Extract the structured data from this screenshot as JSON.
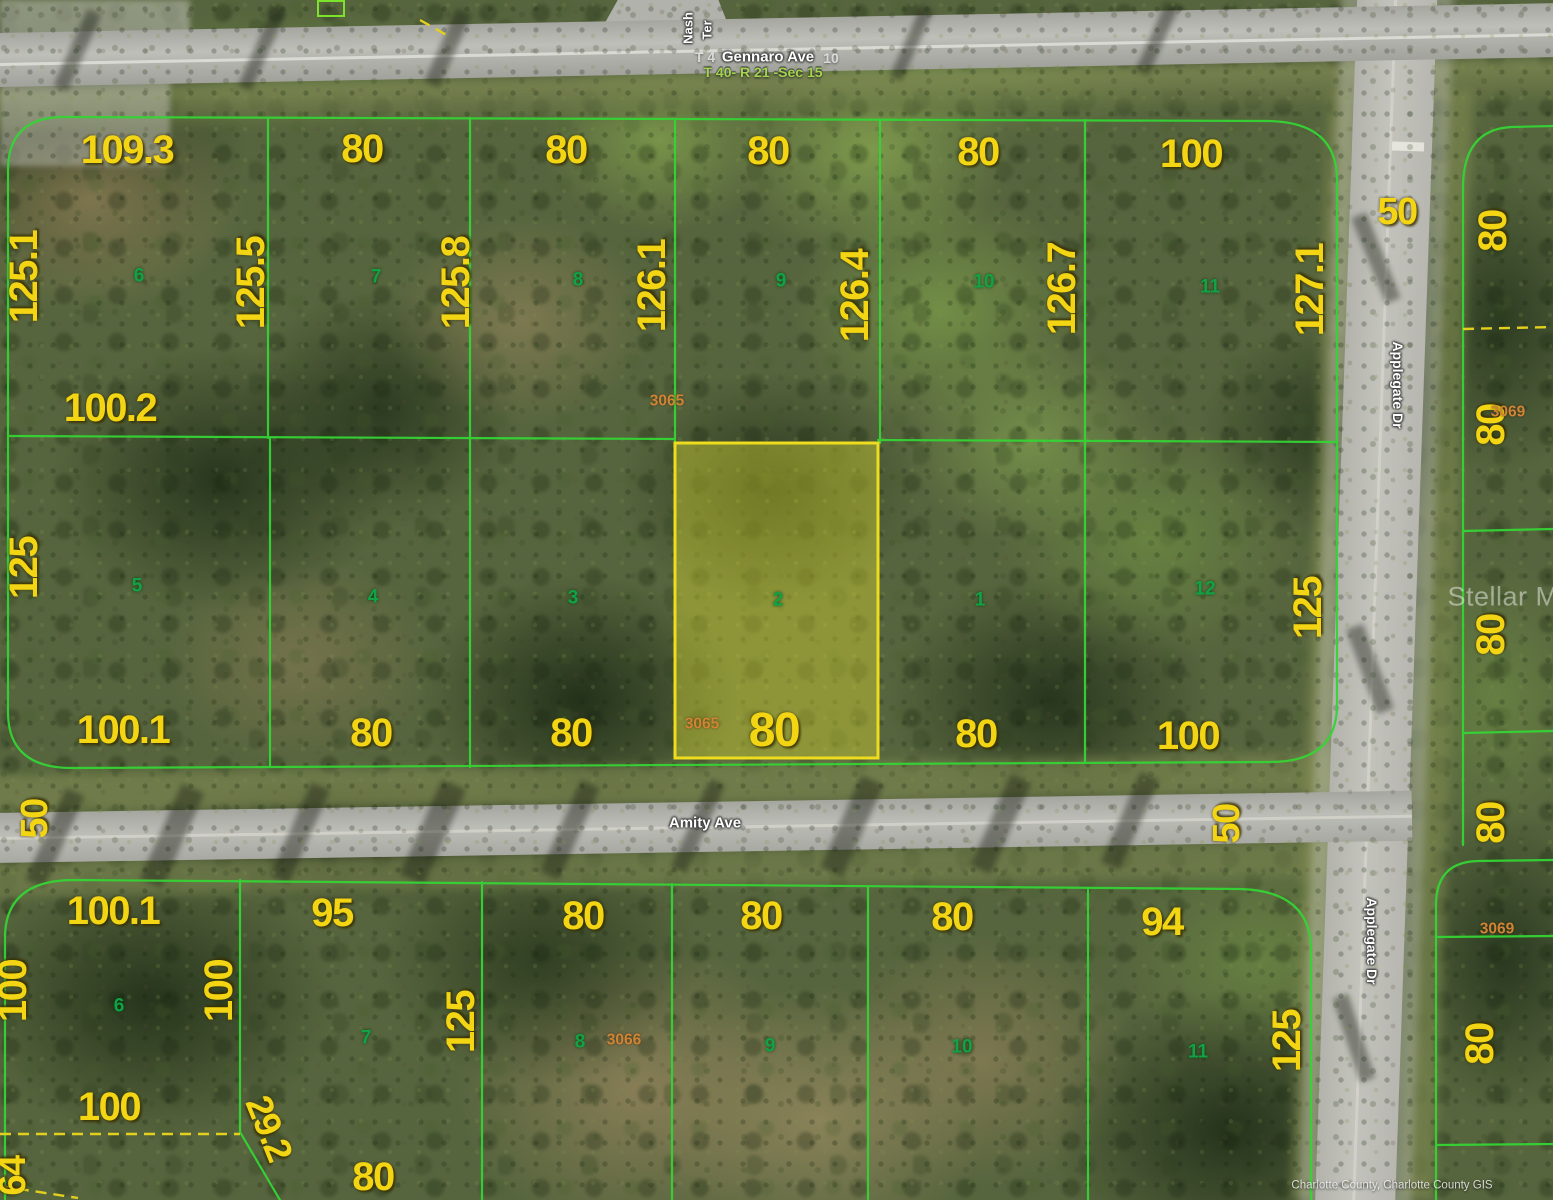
{
  "map": {
    "type": "aerial-parcel-map",
    "subject_parcel": {
      "lot": "2",
      "parcel_id": "3065",
      "frontage": "80",
      "highlighted": true
    },
    "watermark": "Stellar MLS",
    "attribution": "Charlotte County, Charlotte County GIS",
    "streets": {
      "north": "Gennaro Ave",
      "middle": "Amity Ave",
      "east": "Applegate Dr",
      "northwest": "Nash Ter",
      "township_range_section": "T 40- R 21 -Sec 15"
    },
    "colors": {
      "boundary_green": "#35d435",
      "dimension_yellow": "#f3d513",
      "lot_number_green": "#12a246",
      "parcel_id_orange": "#d08434",
      "highlight_stroke": "#eedc1e",
      "highlight_fill": "rgba(232,228,50,0.38)",
      "dashed_yellow": "#e3cf1e",
      "road_gray": "#b3b3ad"
    }
  },
  "labels": [
    {
      "name": "street-nash-line1",
      "kind": "street",
      "text": "Nash",
      "x": 688,
      "y": 28,
      "rot": -90,
      "size": 13
    },
    {
      "name": "street-nash-line2",
      "kind": "street",
      "text": "Ter",
      "x": 707,
      "y": 30,
      "rot": -90,
      "size": 13
    },
    {
      "name": "street-gennaro-prefix",
      "kind": "street-faint",
      "text": "T 4",
      "x": 705,
      "y": 57
    },
    {
      "name": "street-gennaro",
      "kind": "street",
      "text": "Gennaro Ave",
      "x": 768,
      "y": 57
    },
    {
      "name": "street-gennaro-suffix",
      "kind": "street-faint",
      "text": "10",
      "x": 831,
      "y": 58
    },
    {
      "name": "township-range-section",
      "kind": "twp",
      "text": "T 40- R 21 -Sec 15",
      "x": 763,
      "y": 72
    },
    {
      "name": "street-amity",
      "kind": "street",
      "text": "Amity Ave",
      "x": 705,
      "y": 823
    },
    {
      "name": "street-applegate-north",
      "kind": "street",
      "text": "Applegate Dr",
      "x": 1398,
      "y": 385,
      "rot": 90,
      "size": 14
    },
    {
      "name": "street-applegate-south",
      "kind": "street",
      "text": "Applegate Dr",
      "x": 1372,
      "y": 941,
      "rot": 90,
      "size": 14
    },
    {
      "name": "dim-109-3",
      "kind": "dim",
      "text": "109.3",
      "x": 127,
      "y": 150
    },
    {
      "name": "dim-80-top-a",
      "kind": "dim",
      "text": "80",
      "x": 362,
      "y": 149
    },
    {
      "name": "dim-80-top-b",
      "kind": "dim",
      "text": "80",
      "x": 566,
      "y": 150
    },
    {
      "name": "dim-80-top-c",
      "kind": "dim",
      "text": "80",
      "x": 768,
      "y": 151
    },
    {
      "name": "dim-80-top-d",
      "kind": "dim",
      "text": "80",
      "x": 978,
      "y": 152
    },
    {
      "name": "dim-100-top",
      "kind": "dim",
      "text": "100",
      "x": 1191,
      "y": 154
    },
    {
      "name": "dim-50-applegate-top",
      "kind": "dim",
      "text": "50",
      "x": 1397,
      "y": 212,
      "size": 38
    },
    {
      "name": "dim-125-1",
      "kind": "dim",
      "text": "125.1",
      "x": 24,
      "y": 277,
      "rot": -90
    },
    {
      "name": "dim-125-5",
      "kind": "dim",
      "text": "125.5",
      "x": 251,
      "y": 283,
      "rot": -90
    },
    {
      "name": "dim-125-8",
      "kind": "dim",
      "text": "125.8",
      "x": 456,
      "y": 283,
      "rot": -90
    },
    {
      "name": "dim-126-1",
      "kind": "dim",
      "text": "126.1",
      "x": 652,
      "y": 286,
      "rot": -90
    },
    {
      "name": "dim-126-4",
      "kind": "dim",
      "text": "126.4",
      "x": 855,
      "y": 296,
      "rot": -90
    },
    {
      "name": "dim-126-7",
      "kind": "dim",
      "text": "126.7",
      "x": 1062,
      "y": 289,
      "rot": -90
    },
    {
      "name": "dim-127-1",
      "kind": "dim",
      "text": "127.1",
      "x": 1310,
      "y": 290,
      "rot": -90
    },
    {
      "name": "dim-100-2",
      "kind": "dim",
      "text": "100.2",
      "x": 110,
      "y": 408
    },
    {
      "name": "dim-125-mid-west",
      "kind": "dim",
      "text": "125",
      "x": 24,
      "y": 568,
      "rot": -90
    },
    {
      "name": "dim-125-mid-east",
      "kind": "dim",
      "text": "125",
      "x": 1308,
      "y": 608,
      "rot": -90
    },
    {
      "name": "dim-100-1-mid",
      "kind": "dim",
      "text": "100.1",
      "x": 123,
      "y": 730
    },
    {
      "name": "dim-80-mid-a",
      "kind": "dim",
      "text": "80",
      "x": 371,
      "y": 733
    },
    {
      "name": "dim-80-mid-b",
      "kind": "dim",
      "text": "80",
      "x": 571,
      "y": 733
    },
    {
      "name": "dim-80-subject",
      "kind": "dim",
      "text": "80",
      "x": 774,
      "y": 731,
      "size": 48
    },
    {
      "name": "dim-80-mid-c",
      "kind": "dim",
      "text": "80",
      "x": 976,
      "y": 734
    },
    {
      "name": "dim-100-mid",
      "kind": "dim",
      "text": "100",
      "x": 1188,
      "y": 736
    },
    {
      "name": "dim-50-amity-west",
      "kind": "dim",
      "text": "50",
      "x": 35,
      "y": 819,
      "rot": -90,
      "size": 38
    },
    {
      "name": "dim-50-amity-east",
      "kind": "dim",
      "text": "50",
      "x": 1227,
      "y": 824,
      "rot": -90,
      "size": 38
    },
    {
      "name": "dim-80-east-1",
      "kind": "dim",
      "text": "80",
      "x": 1493,
      "y": 231,
      "rot": -90
    },
    {
      "name": "dim-80-east-2",
      "kind": "dim",
      "text": "80",
      "x": 1491,
      "y": 425,
      "rot": -90
    },
    {
      "name": "dim-80-east-3",
      "kind": "dim",
      "text": "80",
      "x": 1491,
      "y": 635,
      "rot": -90
    },
    {
      "name": "dim-80-east-4",
      "kind": "dim",
      "text": "80",
      "x": 1491,
      "y": 823,
      "rot": -90
    },
    {
      "name": "dim-80-east-5",
      "kind": "dim",
      "text": "80",
      "x": 1480,
      "y": 1044,
      "rot": -90
    },
    {
      "name": "dim-100-1-south",
      "kind": "dim",
      "text": "100.1",
      "x": 113,
      "y": 911
    },
    {
      "name": "dim-95",
      "kind": "dim",
      "text": "95",
      "x": 332,
      "y": 913
    },
    {
      "name": "dim-80-south-a",
      "kind": "dim",
      "text": "80",
      "x": 583,
      "y": 916
    },
    {
      "name": "dim-80-south-b",
      "kind": "dim",
      "text": "80",
      "x": 761,
      "y": 916
    },
    {
      "name": "dim-80-south-c",
      "kind": "dim",
      "text": "80",
      "x": 952,
      "y": 917
    },
    {
      "name": "dim-94",
      "kind": "dim",
      "text": "94",
      "x": 1162,
      "y": 922
    },
    {
      "name": "dim-100-sw-edge",
      "kind": "dim",
      "text": "100",
      "x": 13,
      "y": 991,
      "rot": -90
    },
    {
      "name": "dim-100-sw",
      "kind": "dim",
      "text": "100",
      "x": 219,
      "y": 991,
      "rot": -90
    },
    {
      "name": "dim-125-south-west",
      "kind": "dim",
      "text": "125",
      "x": 461,
      "y": 1022,
      "rot": -90
    },
    {
      "name": "dim-125-south-east",
      "kind": "dim",
      "text": "125",
      "x": 1287,
      "y": 1041,
      "rot": -90
    },
    {
      "name": "dim-100-bottom",
      "kind": "dim",
      "text": "100",
      "x": 109,
      "y": 1107
    },
    {
      "name": "dim-29-2",
      "kind": "dim",
      "text": "29.2",
      "x": 269,
      "y": 1128,
      "rot": 68,
      "size": 37
    },
    {
      "name": "dim-64",
      "kind": "dim",
      "text": "64",
      "x": 13,
      "y": 1176,
      "rot": -90,
      "size": 38
    },
    {
      "name": "dim-80-bottom",
      "kind": "dim",
      "text": "80",
      "x": 373,
      "y": 1177
    },
    {
      "name": "lot-6-north",
      "kind": "lot",
      "text": "6",
      "x": 139,
      "y": 276
    },
    {
      "name": "lot-7-north",
      "kind": "lot",
      "text": "7",
      "x": 376,
      "y": 277
    },
    {
      "name": "lot-8-north",
      "kind": "lot",
      "text": "8",
      "x": 578,
      "y": 280
    },
    {
      "name": "lot-9-north",
      "kind": "lot",
      "text": "9",
      "x": 781,
      "y": 281
    },
    {
      "name": "lot-10-north",
      "kind": "lot",
      "text": "10",
      "x": 984,
      "y": 282
    },
    {
      "name": "lot-11-north",
      "kind": "lot",
      "text": "11",
      "x": 1210,
      "y": 287
    },
    {
      "name": "lot-5",
      "kind": "lot",
      "text": "5",
      "x": 137,
      "y": 586
    },
    {
      "name": "lot-4",
      "kind": "lot",
      "text": "4",
      "x": 373,
      "y": 597
    },
    {
      "name": "lot-3",
      "kind": "lot",
      "text": "3",
      "x": 573,
      "y": 598
    },
    {
      "name": "lot-2-subject",
      "kind": "lot",
      "text": "2",
      "x": 778,
      "y": 600
    },
    {
      "name": "lot-1",
      "kind": "lot",
      "text": "1",
      "x": 980,
      "y": 600
    },
    {
      "name": "lot-12",
      "kind": "lot",
      "text": "12",
      "x": 1205,
      "y": 589
    },
    {
      "name": "lot-6-south",
      "kind": "lot",
      "text": "6",
      "x": 119,
      "y": 1006
    },
    {
      "name": "lot-7-south",
      "kind": "lot",
      "text": "7",
      "x": 366,
      "y": 1038
    },
    {
      "name": "lot-8-south",
      "kind": "lot",
      "text": "8",
      "x": 580,
      "y": 1042
    },
    {
      "name": "lot-9-south",
      "kind": "lot",
      "text": "9",
      "x": 770,
      "y": 1046
    },
    {
      "name": "lot-10-south",
      "kind": "lot",
      "text": "10",
      "x": 962,
      "y": 1047
    },
    {
      "name": "lot-11-south",
      "kind": "lot",
      "text": "11",
      "x": 1198,
      "y": 1052
    },
    {
      "name": "parcel-id-3065-top",
      "kind": "pid",
      "text": "3065",
      "x": 667,
      "y": 401
    },
    {
      "name": "parcel-id-3065-subject",
      "kind": "pid",
      "text": "3065",
      "x": 702,
      "y": 724
    },
    {
      "name": "parcel-id-3066",
      "kind": "pid",
      "text": "3066",
      "x": 624,
      "y": 1040
    },
    {
      "name": "parcel-id-3069-north",
      "kind": "pid",
      "text": "3069",
      "x": 1508,
      "y": 412
    },
    {
      "name": "parcel-id-3069-south",
      "kind": "pid",
      "text": "3069",
      "x": 1497,
      "y": 929
    },
    {
      "name": "mls-watermark",
      "kind": "watermark",
      "text": "Stellar MLS",
      "x": 1520,
      "y": 597
    },
    {
      "name": "county-attribution",
      "kind": "attr",
      "text": "Charlotte County, Charlotte County GIS",
      "x": 1392,
      "y": 1186
    }
  ]
}
